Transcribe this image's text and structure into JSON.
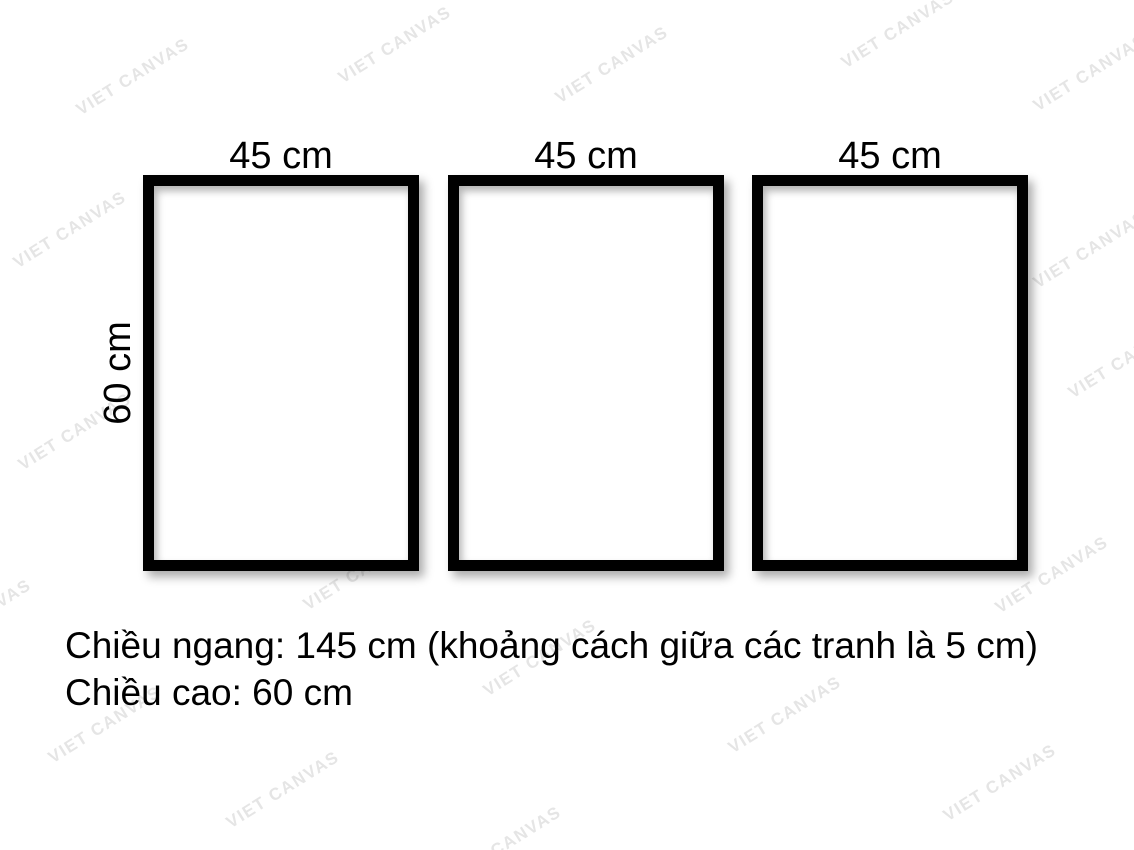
{
  "frames": [
    {
      "width_label": "45 cm"
    },
    {
      "width_label": "45 cm"
    },
    {
      "width_label": "45 cm"
    }
  ],
  "height_label": "60 cm",
  "notes": {
    "line1": "Chiều ngang: 145 cm (khoảng cách giữa các tranh là 5 cm)",
    "line2": "Chiều cao: 60 cm"
  },
  "watermark": {
    "text": "VIET CANVAS",
    "color": "#e5e5e5",
    "angle_deg": -32,
    "positions": [
      {
        "x": 133,
        "y": 77
      },
      {
        "x": 395,
        "y": 45
      },
      {
        "x": 612,
        "y": 65
      },
      {
        "x": 898,
        "y": 30
      },
      {
        "x": 1090,
        "y": 73
      },
      {
        "x": 70,
        "y": 230
      },
      {
        "x": 363,
        "y": 233
      },
      {
        "x": 581,
        "y": 247
      },
      {
        "x": 855,
        "y": 235
      },
      {
        "x": 1090,
        "y": 250
      },
      {
        "x": 75,
        "y": 432
      },
      {
        "x": 305,
        "y": 420
      },
      {
        "x": 570,
        "y": 430
      },
      {
        "x": 825,
        "y": 497
      },
      {
        "x": 1125,
        "y": 360
      },
      {
        "x": 360,
        "y": 572
      },
      {
        "x": 1052,
        "y": 575
      },
      {
        "x": -25,
        "y": 618
      },
      {
        "x": 540,
        "y": 658
      },
      {
        "x": 105,
        "y": 725
      },
      {
        "x": 785,
        "y": 715
      },
      {
        "x": 283,
        "y": 790
      },
      {
        "x": 1000,
        "y": 783
      },
      {
        "x": 505,
        "y": 845
      }
    ]
  },
  "colors": {
    "background": "#ffffff",
    "frame_border": "#000000",
    "text": "#000000"
  }
}
